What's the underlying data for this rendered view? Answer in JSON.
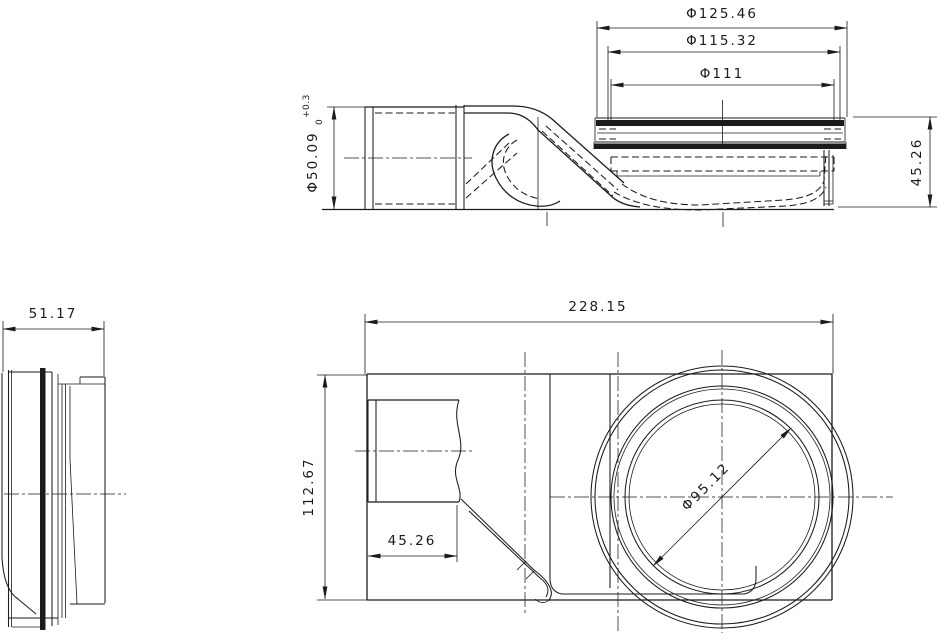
{
  "page": {
    "background": "#ffffff",
    "ink_color": "#1b1b1b"
  },
  "views": {
    "side_elevation": {
      "dims": {
        "flange_outer_dia": "Φ125.46",
        "flange_mid_dia": "Φ115.32",
        "flange_inner_dia": "Φ111",
        "pipe_dia": "Φ50.09",
        "pipe_tol_upper": "+0.3",
        "pipe_tol_lower": "0",
        "flange_height": "45.26"
      }
    },
    "end_view": {
      "dims": {
        "depth": "51.17"
      }
    },
    "plan_view": {
      "dims": {
        "overall_length": "228.15",
        "overall_width": "112.67",
        "stub_length": "45.26",
        "drain_dia": "Φ95.12"
      }
    }
  }
}
